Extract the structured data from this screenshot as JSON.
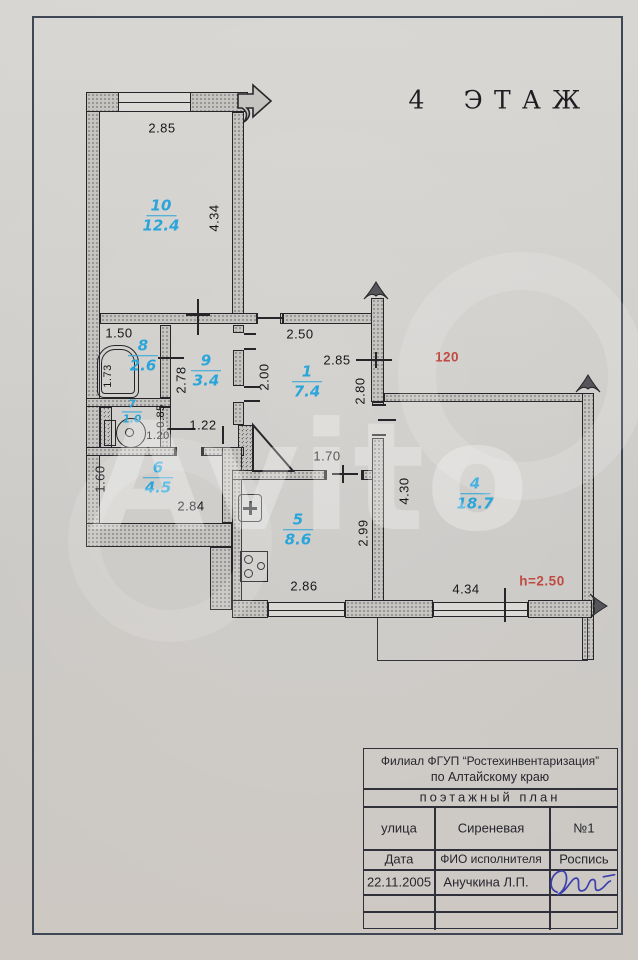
{
  "header": {
    "floor_title": "4 ЭТАЖ"
  },
  "watermark": {
    "text": "Avito"
  },
  "plan": {
    "rooms": [
      {
        "num": "10",
        "area": "12.4"
      },
      {
        "num": "8",
        "area": "2.6"
      },
      {
        "num": "9",
        "area": "3.4"
      },
      {
        "num": "7",
        "area": "1.0"
      },
      {
        "num": "6",
        "area": "4.5"
      },
      {
        "num": "1",
        "area": "7.4"
      },
      {
        "num": "5",
        "area": "8.6"
      },
      {
        "num": "4",
        "area": "18.7"
      }
    ],
    "dimensions": [
      {
        "text": "2.85"
      },
      {
        "text": "4.34"
      },
      {
        "text": "1.50"
      },
      {
        "text": "1.73"
      },
      {
        "text": "2.78"
      },
      {
        "text": "2.50"
      },
      {
        "text": "2.00"
      },
      {
        "text": "2.85"
      },
      {
        "text": "2.80"
      },
      {
        "text": "0.85"
      },
      {
        "text": "1.20"
      },
      {
        "text": "1.22"
      },
      {
        "text": "1.60"
      },
      {
        "text": "2.84"
      },
      {
        "text": "1.70"
      },
      {
        "text": "2.86"
      },
      {
        "text": "2.99"
      },
      {
        "text": "4.30"
      },
      {
        "text": "4.34"
      }
    ],
    "annotations": [
      {
        "text": "120"
      },
      {
        "text": "h=2.50"
      }
    ]
  },
  "title_block": {
    "org_line1": "Филиал ФГУП “Ростехинвентаризация”",
    "org_line2": "по Алтайскому краю",
    "doc_type": "поэтажный план",
    "street_label": "улица",
    "street_value": "Сиреневая",
    "house_number": "№1",
    "date_label": "Дата",
    "executor_label": "ФИО исполнителя",
    "sign_label": "Роспись",
    "date_value": "22.11.2005",
    "executor_value": "Анучкина Л.П."
  },
  "colors": {
    "room_label": "#2aa5da",
    "annotation_red": "#bf4a42",
    "signature_ink": "#3c3fae"
  }
}
